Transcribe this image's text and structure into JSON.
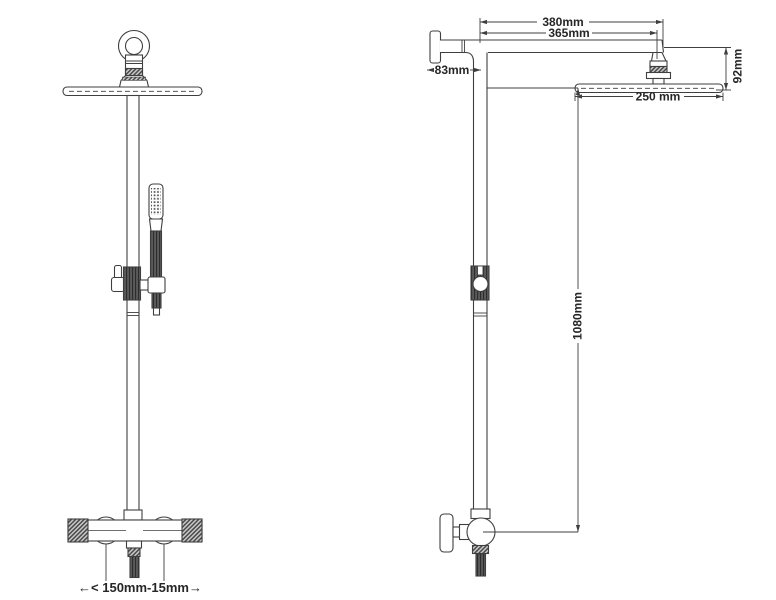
{
  "drawing": {
    "background_color": "#ffffff",
    "line_color": "#3f3f3f",
    "text_color": "#262626",
    "dimensions": {
      "arm_length_overall": "380mm",
      "arm_length_to_head_center": "365mm",
      "wall_to_riser_offset": "83mm",
      "head_assembly_drop": "92mm",
      "head_diameter": "250 mm",
      "riser_height": "1080mm",
      "inlet_centers": "←< 150mm-15mm→"
    }
  }
}
